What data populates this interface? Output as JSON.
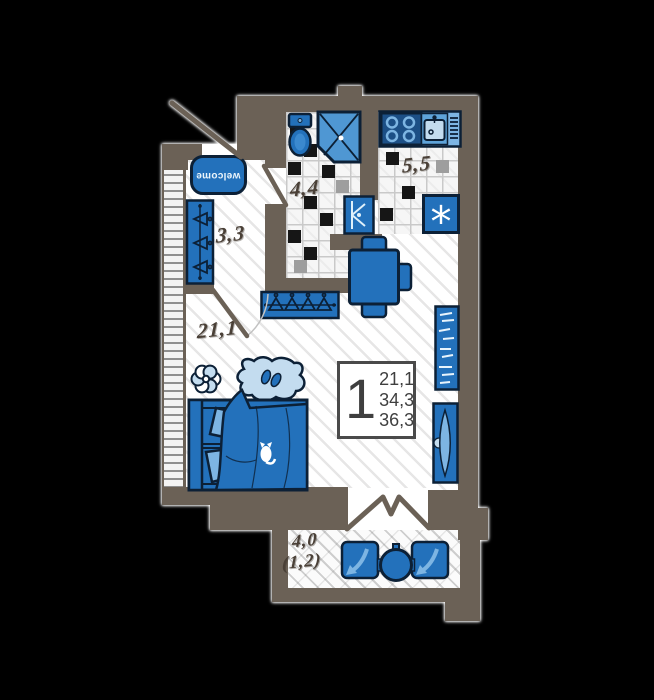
{
  "colors": {
    "wall": "#6b6156",
    "blue": "#2371bb",
    "blue_dark": "#1c4f86",
    "blue_light": "#7db5e3",
    "blue_pale": "#c3dcef",
    "outline": "#0c2036",
    "label_text": "#4a4037",
    "info_text": "#3f3f3f"
  },
  "rooms": {
    "bathroom": {
      "area": "4,4"
    },
    "kitchen": {
      "area": "5,5"
    },
    "hallway": {
      "area": "3,3"
    },
    "living_room": {
      "area": "21,1"
    },
    "balcony": {
      "area": "4,0",
      "area_reduced": "(1,2)"
    }
  },
  "info_box": {
    "rooms_count": "1",
    "living_area": "21,1",
    "apartment_area": "34,3",
    "total_area": "36,3"
  },
  "door_mat": {
    "text": "welcome"
  },
  "fridge": {
    "symbol": "*"
  }
}
